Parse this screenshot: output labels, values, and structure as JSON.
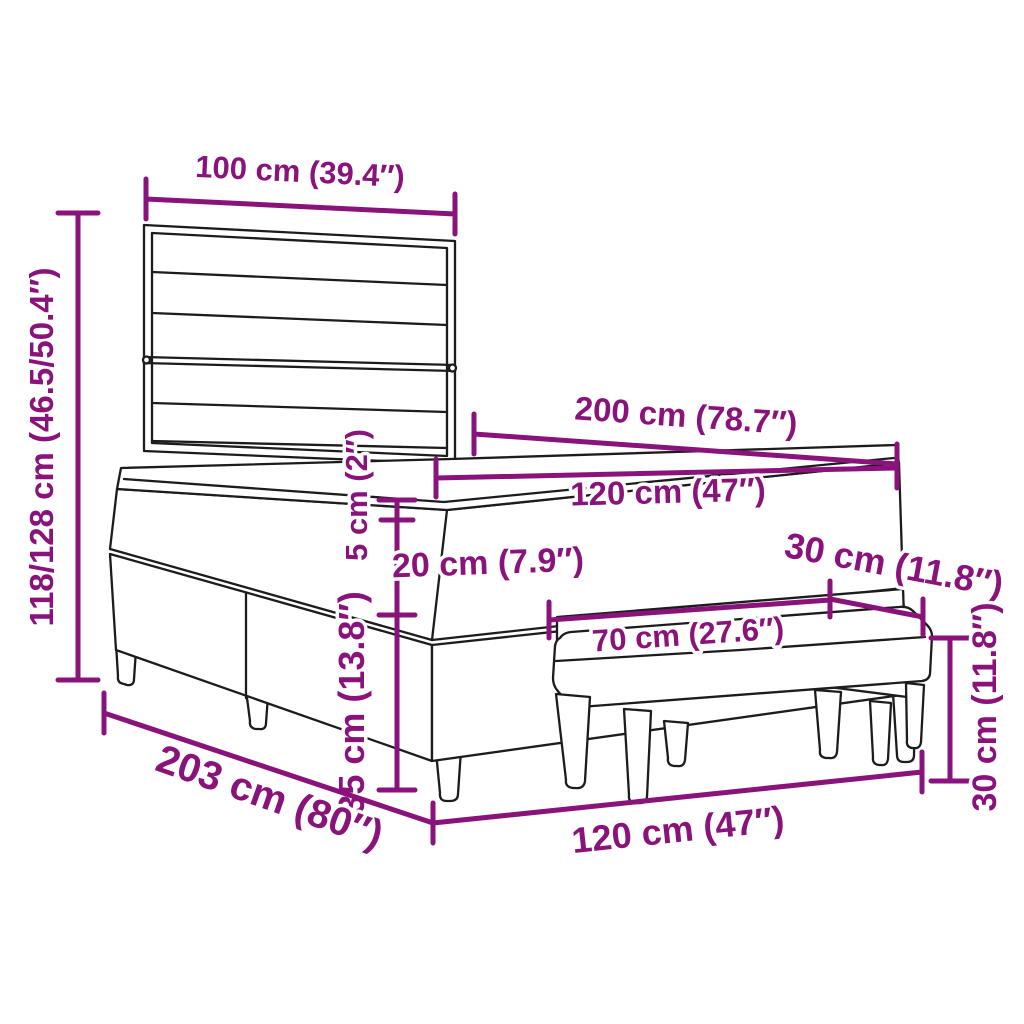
{
  "colors": {
    "accent": "#8A127B",
    "line": "#1C1C1C",
    "background": "#FFFFFF"
  },
  "dimensions": {
    "headboard_width": "100 cm (39.4″)",
    "overall_height": "118/128 cm (46.5/50.4″)",
    "bed_length": "200 cm (78.7″)",
    "mattress_width": "120 cm (47″)",
    "topper_thickness": "5 cm (2″)",
    "mattress_thickness": "20 cm (7.9″)",
    "bench_depth": "30 cm (11.8″)",
    "bench_length": "70 cm (27.6″)",
    "base_height": "35 cm (13.8″)",
    "bench_height": "30 cm (11.8″)",
    "frame_length": "203 cm (80″)",
    "bed_width": "120 cm (47″)"
  }
}
